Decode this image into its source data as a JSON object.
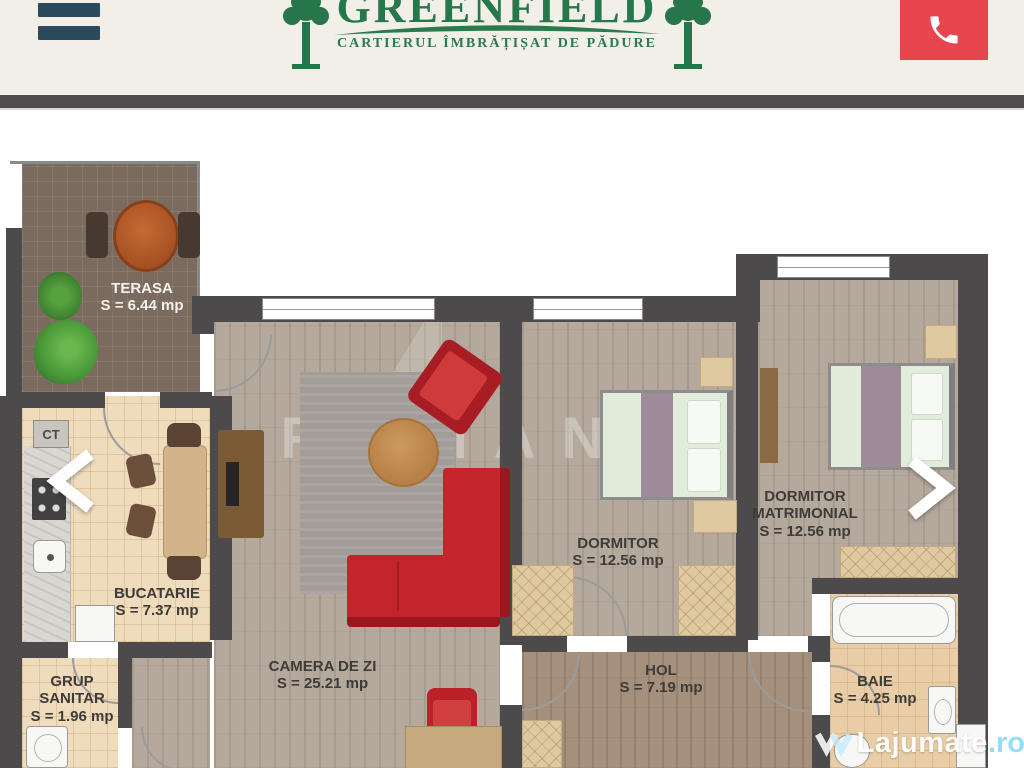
{
  "header": {
    "logo_title": "GREENFIELD",
    "logo_tagline": "CARTIERUL ÎMBRĂȚIȘAT DE PĂDURE",
    "colors": {
      "header_bg": "#f2efe8",
      "brand_green": "#26784a",
      "phone_red": "#e8464f",
      "menu_dark": "#2b4a5c"
    }
  },
  "carousel": {
    "prev_icon": "chevron-left",
    "next_icon": "chevron-right"
  },
  "floorplan": {
    "boiler_label": "CT",
    "watermark_text": "ROMANIA",
    "rooms": [
      {
        "id": "terasa",
        "name": "TERASA",
        "area": "S = 6.44 mp"
      },
      {
        "id": "bucatarie",
        "name": "BUCATARIE",
        "area": "S = 7.37 mp"
      },
      {
        "id": "grup-sanitar",
        "name": "GRUP SANITAR",
        "area": "S = 1.96 mp"
      },
      {
        "id": "camera-de-zi",
        "name": "CAMERA DE ZI",
        "area": "S = 25.21 mp"
      },
      {
        "id": "dormitor",
        "name": "DORMITOR",
        "area": "S = 12.56 mp"
      },
      {
        "id": "dormitor-matrimonial",
        "name": "DORMITOR MATRIMONIAL",
        "area": "S = 12.56 mp"
      },
      {
        "id": "hol",
        "name": "HOL",
        "area": "S = 7.19 mp"
      },
      {
        "id": "baie",
        "name": "BAIE",
        "area": "S = 4.25 mp"
      }
    ],
    "colors": {
      "wall": "#4d4a4b",
      "sofa_red": "#c4242b",
      "terrace_tile": "#7b6b5e",
      "kitchen_tile": "#eedcbd"
    }
  },
  "site_watermark": {
    "name": "Lajumate",
    "tld": ".ro"
  }
}
